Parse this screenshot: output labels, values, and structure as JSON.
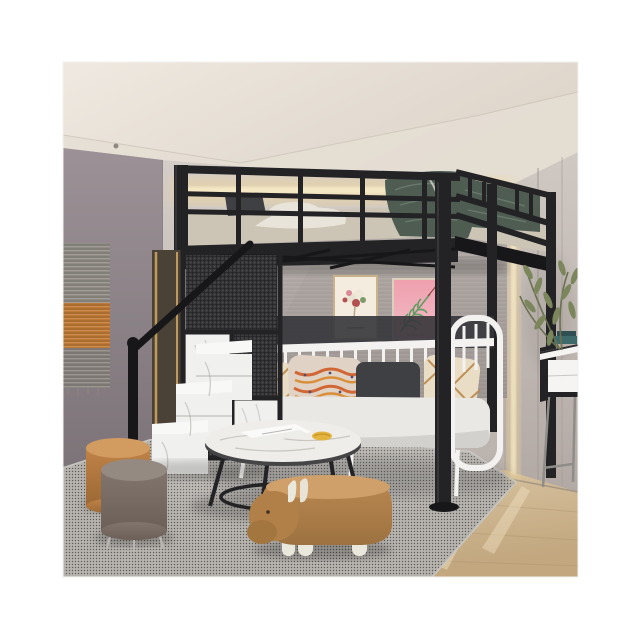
{
  "image": {
    "kind": "product-photo",
    "subject": "black metal loft bed with storage staircase above a white metal daybed in a styled bedroom"
  },
  "palette": {
    "bg": "#ffffff",
    "ceiling_hi": "#efe9e1",
    "ceiling_lo": "#ddd4c9",
    "soffit": "#e5ded4",
    "wall_left_hi": "#9b9196",
    "wall_left_lo": "#7c7378",
    "wall_back_hi": "#d4cdc7",
    "wall_back_lo": "#bab2ad",
    "wall_right_hi": "#d0c8c2",
    "wall_right_lo": "#b2a9a4",
    "panel_gray_hi": "#b4adaa",
    "panel_gray_lo": "#9e9793",
    "led_glow": "#f0d79c",
    "led_core": "#faeecb",
    "metal_black": "#232325",
    "metal_dark": "#171719",
    "metal_hi": "#3c3c40",
    "mattress": "#ccc4b5",
    "bedding_white": "#e9e4da",
    "bedding_teal": "#4e5c52",
    "bedding_teal_hi": "#6c7d6f",
    "sofa_white": "#f3f2f0",
    "cushion": "#e9e8e4",
    "cushion_sh": "#d2d1cd",
    "pillow_cream": "#eaddc5",
    "pillow_tan": "#b9884d",
    "pillow_orange_bg": "#e0d3c6",
    "pillow_orange": "#d2622f",
    "pillow_gold": "#d98c33",
    "pillow_dark": "#3e4043",
    "marble": "#efedea",
    "marble_vein": "#c6c3bd",
    "table_rim": "#454547",
    "rug_base": "#b7b3ae",
    "rug_dark": "#605e5a",
    "rug_light": "#dedcd7",
    "wood_hi": "#e0cfae",
    "wood_lo": "#c2a77f",
    "wood_line": "#a98d68",
    "pouf_caramel": "#c08347",
    "pouf_caramel_hi": "#d29b60",
    "pouf_taupe": "#82756d",
    "pouf_taupe_hi": "#958a82",
    "hippo": "#bb8951",
    "hippo_hi": "#cfa069",
    "hippo_leg": "#eae7dd",
    "step_white": "#f0f0ee",
    "step_top": "#f8f8f6",
    "mesh_bg": "#3a3a3c",
    "mesh_line": "#1a1b1d",
    "gold_trim": "#bf9a5d",
    "panel_wood_dark": "#4a4236",
    "desk_white": "#f5f4f2",
    "desk_leg": "#8f8d89",
    "book_teal": "#3e6a6b",
    "book_dark": "#2f4f52",
    "plant_green": "#7c865c",
    "plant_stem": "#6b7051",
    "art_frame": "#c8b28a",
    "art_cream": "#f3ecdf",
    "art_pink": "#f2bfc9",
    "art_leaf": "#5f9e63",
    "art_red": "#b44f52",
    "switch": "#e8e5e0",
    "tapestry_gray": "#918c86",
    "tapestry_orange": "#c07a35",
    "tapestry_gray2": "#8a857f",
    "croissant": "#e4b53e"
  }
}
